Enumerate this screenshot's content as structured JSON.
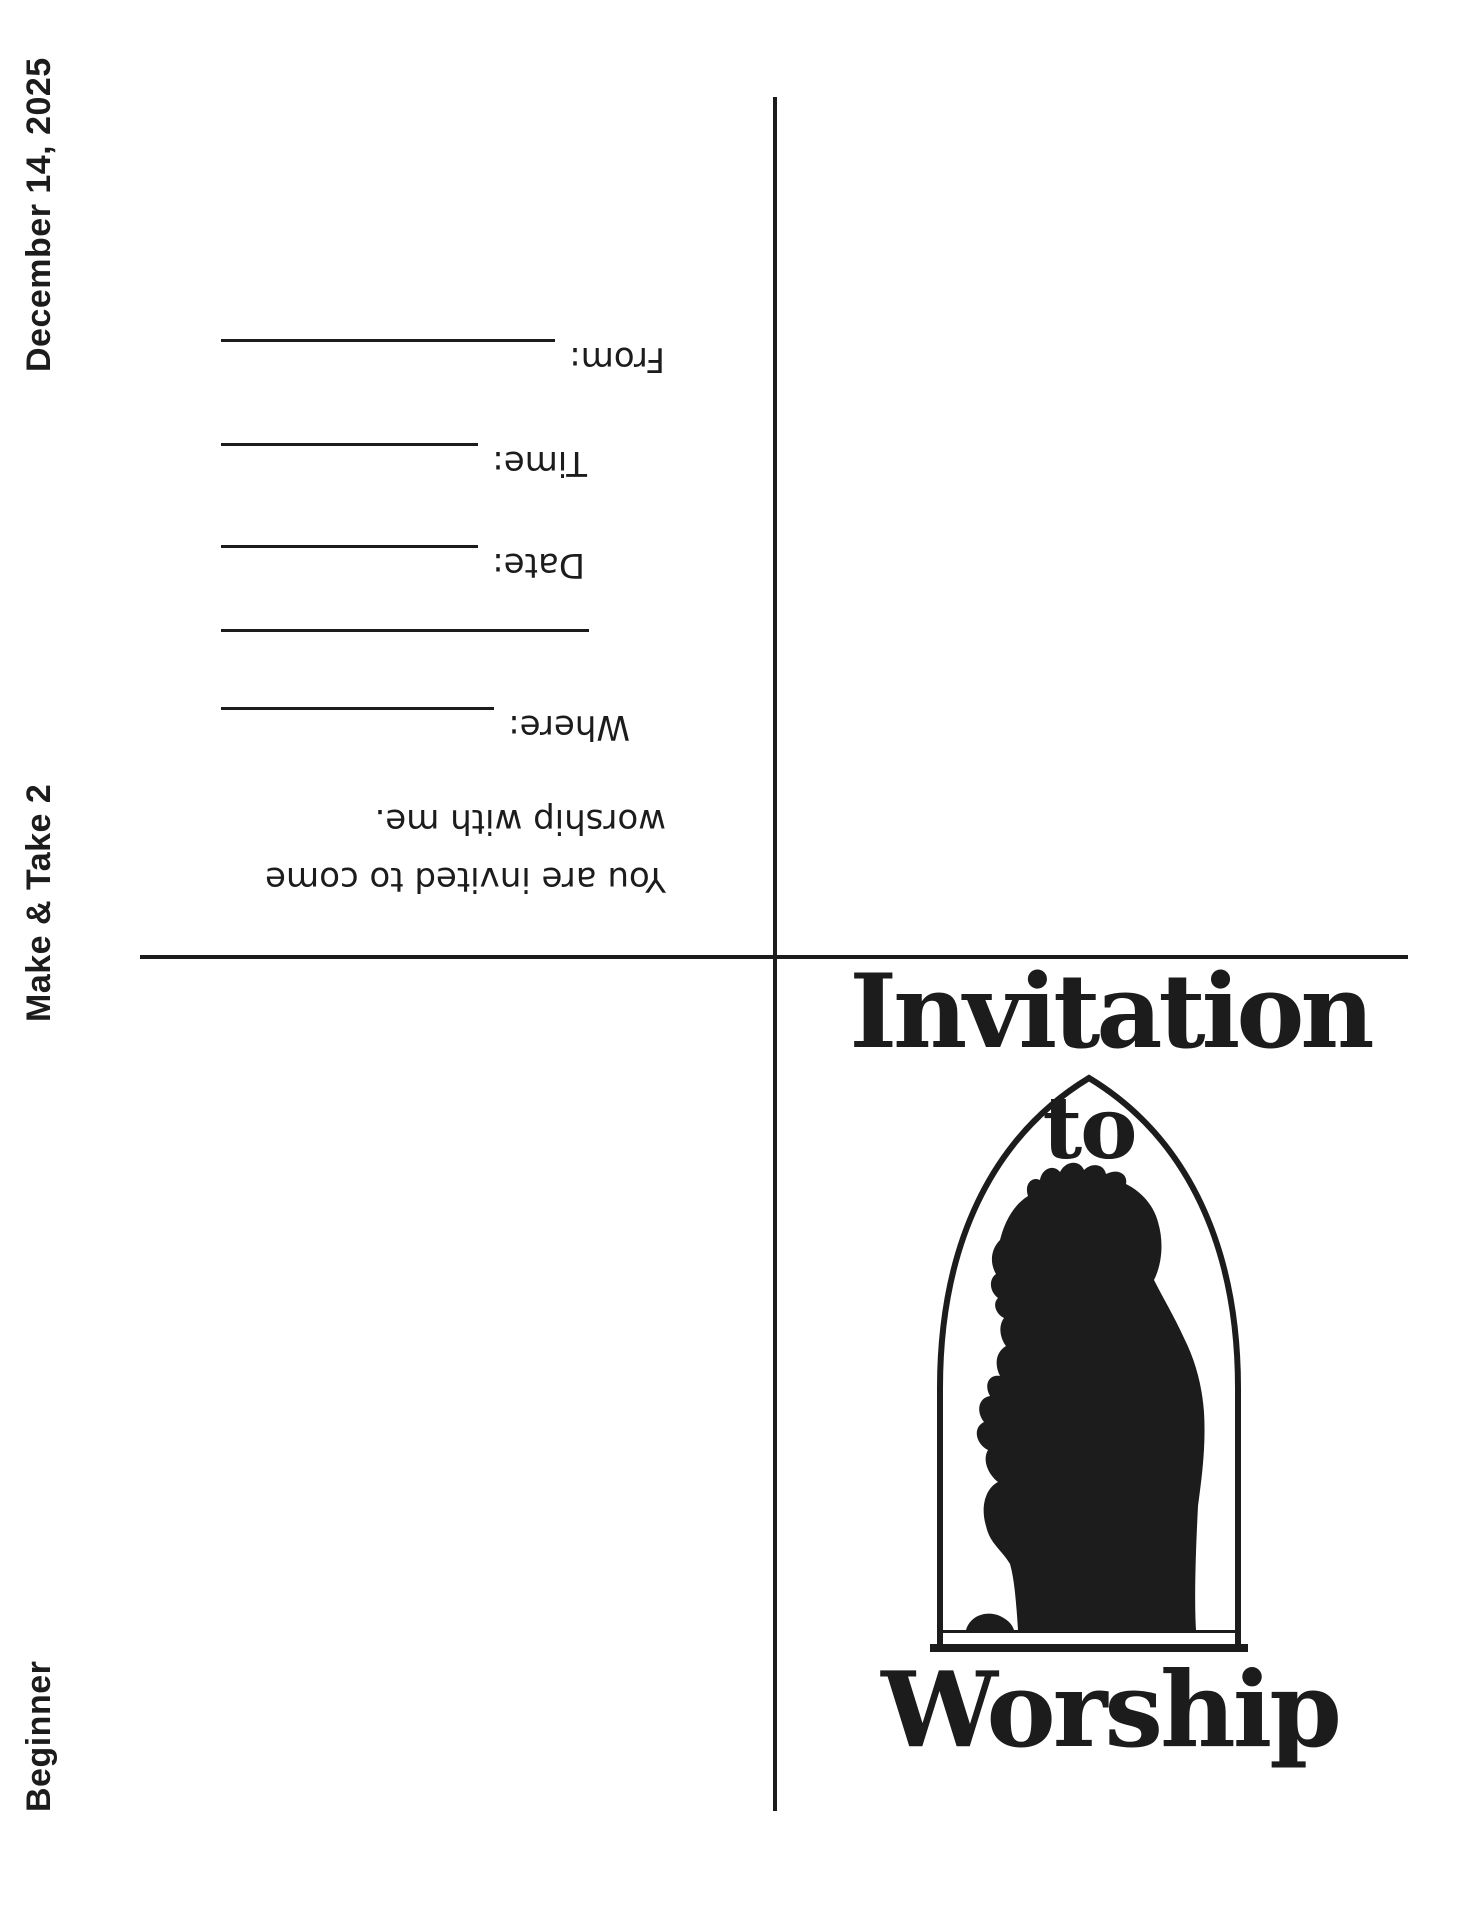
{
  "page": {
    "margin_labels": {
      "date": "December 14, 2025",
      "series": "Make & Take 2",
      "level": "Beginner"
    },
    "card_front": {
      "title_line1": "Invitation",
      "title_line2": "to",
      "title_line3": "Worship",
      "image": "praying-child-silhouette-in-arch-window"
    },
    "card_back": {
      "invite_text_line1": "You are invited to come",
      "invite_text_line2": "worship with me.",
      "fields": [
        {
          "label": "Where:"
        },
        {
          "label": "Date:"
        },
        {
          "label": "Time:"
        },
        {
          "label": "From:"
        }
      ]
    },
    "colors": {
      "ink": "#1c1c1c",
      "background": "#ffffff"
    }
  }
}
